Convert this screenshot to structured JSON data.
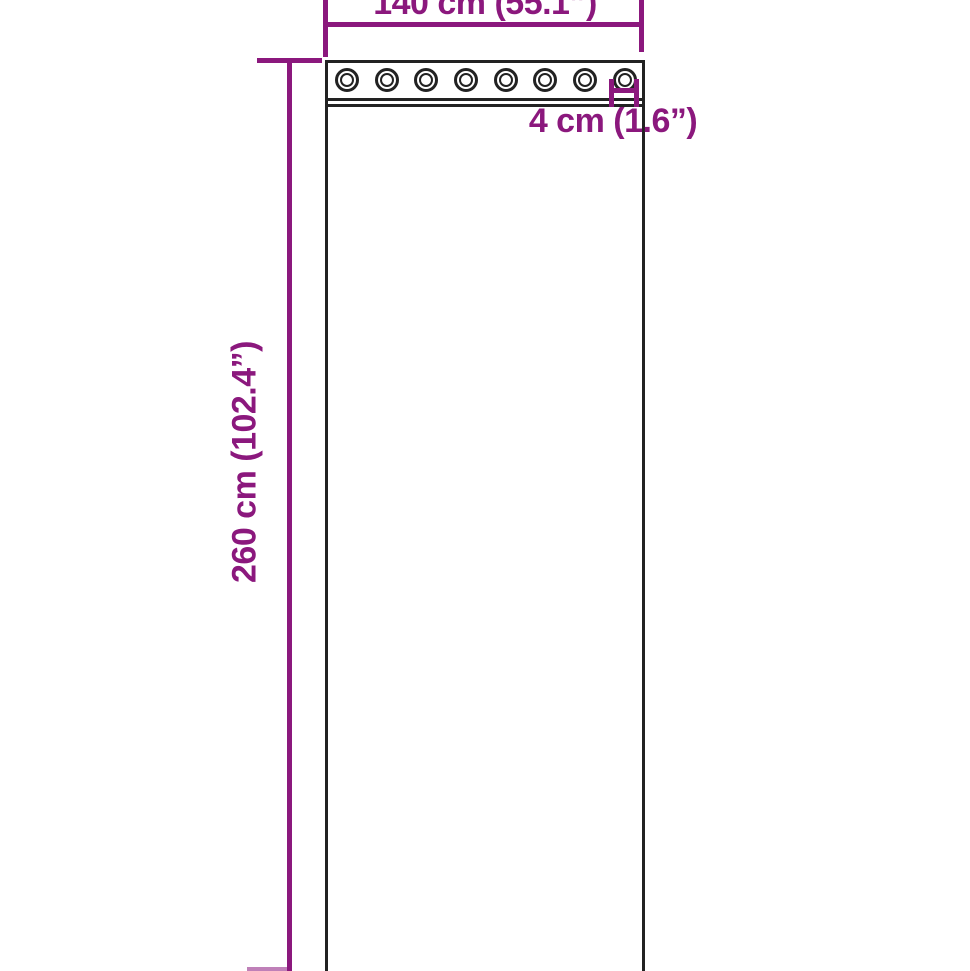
{
  "title": "Curtain dimension diagram",
  "colors": {
    "accent_purple": "#8B187D",
    "outline_dark": "#222222",
    "background": "#FFFFFF"
  },
  "dimensions": {
    "width_label": "140 cm (55.1”)",
    "height_label": "260 cm (102.4”)",
    "grommet_diameter_label": "4 cm (1.6”)"
  },
  "curtain": {
    "grommet_count": 8
  }
}
